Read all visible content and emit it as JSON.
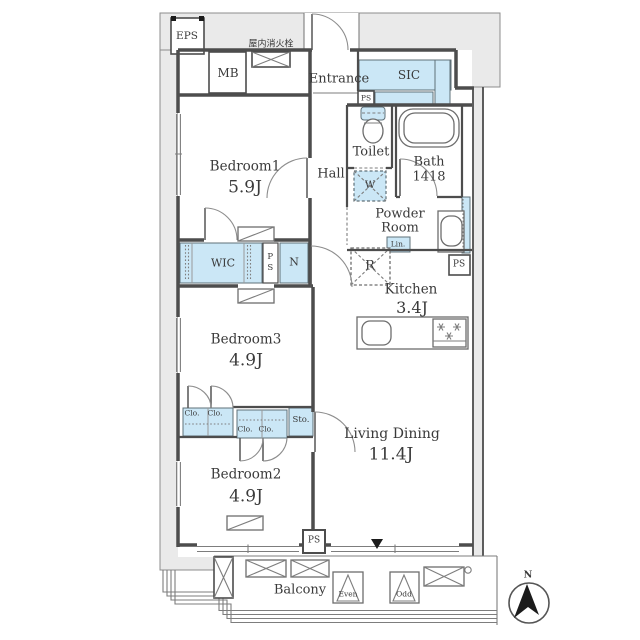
{
  "plan": {
    "common": {
      "eps": "EPS",
      "mb": "MB",
      "fire_hydrant": "屋内消火栓",
      "entrance": "Entrance",
      "sic": "SIC",
      "ps": "PS"
    },
    "rooms": {
      "bedroom1": {
        "name": "Bedroom1",
        "area": "5.9J"
      },
      "bedroom2": {
        "name": "Bedroom2",
        "area": "4.9J"
      },
      "bedroom3": {
        "name": "Bedroom3",
        "area": "4.9J"
      },
      "living_dining": {
        "name": "Living Dining",
        "area": "11.4J"
      },
      "kitchen": {
        "name": "Kitchen",
        "area": "3.4J"
      },
      "hall": {
        "name": "Hall"
      },
      "toilet": {
        "name": "Toilet"
      },
      "bath": {
        "name": "Bath",
        "size": "1418"
      },
      "powder_room": {
        "line1": "Powder",
        "line2": "Room"
      },
      "wic": {
        "name": "WIC"
      },
      "nando": {
        "name": "N"
      }
    },
    "storage": {
      "clo": "Clo.",
      "sto": "Sto.",
      "lin": "Lin."
    },
    "fixtures": {
      "washer": "W",
      "fridge": "R"
    },
    "balcony": {
      "name": "Balcony",
      "hatch_even": "Even",
      "hatch_odd": "Odd"
    },
    "compass": {
      "north": "N"
    }
  },
  "colors": {
    "storage_blue": "#cbe7f6",
    "common_gray": "#eaeaea",
    "wall": "#4d4d4d",
    "text": "#3a3a3a"
  }
}
